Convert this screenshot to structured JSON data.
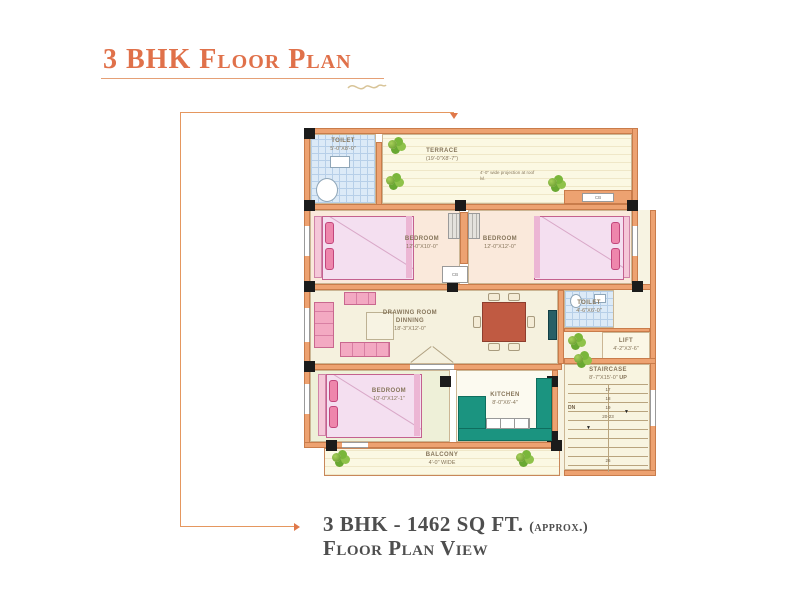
{
  "title": "3 BHK Floor Plan",
  "footer": {
    "size_text": "3 BHK - 1462 SQ FT.",
    "approx_text": "(approx.)",
    "view_text": "Floor Plan View"
  },
  "plan": {
    "toilet_top": {
      "name": "TOILET",
      "dim": "5'-0\"X8'-0\""
    },
    "terrace": {
      "name": "TERRACE",
      "dim": "(19'-0\"X8'-7\")"
    },
    "terrace_note": "4'-0\" wide projection at roof lvl.",
    "bedroom_top_left": {
      "name": "BEDROOM",
      "dim": "12'-0\"X10'-0\""
    },
    "bedroom_top_right": {
      "name": "BEDROOM",
      "dim": "12'-0\"X12'-0\""
    },
    "drawing_room": {
      "name": "DRAWING ROOM",
      "name2": "DINNING",
      "dim": "18'-3\"X12'-0\""
    },
    "toilet_mid": {
      "name": "TOILET",
      "dim": "4'-6\"X6'-0\""
    },
    "lift": {
      "name": "LIFT",
      "dim": "4'-2\"X3'-6\""
    },
    "bedroom_bottom": {
      "name": "BEDROOM",
      "dim": "10'-0\"X12'-1\""
    },
    "kitchen": {
      "name": "KITCHEN",
      "dim": "8'-0\"X6'-4\""
    },
    "staircase": {
      "name": "STAIRCASE",
      "dim": "8'-7\"X15'-0\"",
      "up": "UP",
      "dn": "DN",
      "steps": [
        "17",
        "18",
        "19",
        "20-23",
        "26"
      ]
    },
    "balcony": {
      "name": "BALCONY",
      "dim": "4'-0\" WIDE"
    },
    "cb": "CB"
  }
}
